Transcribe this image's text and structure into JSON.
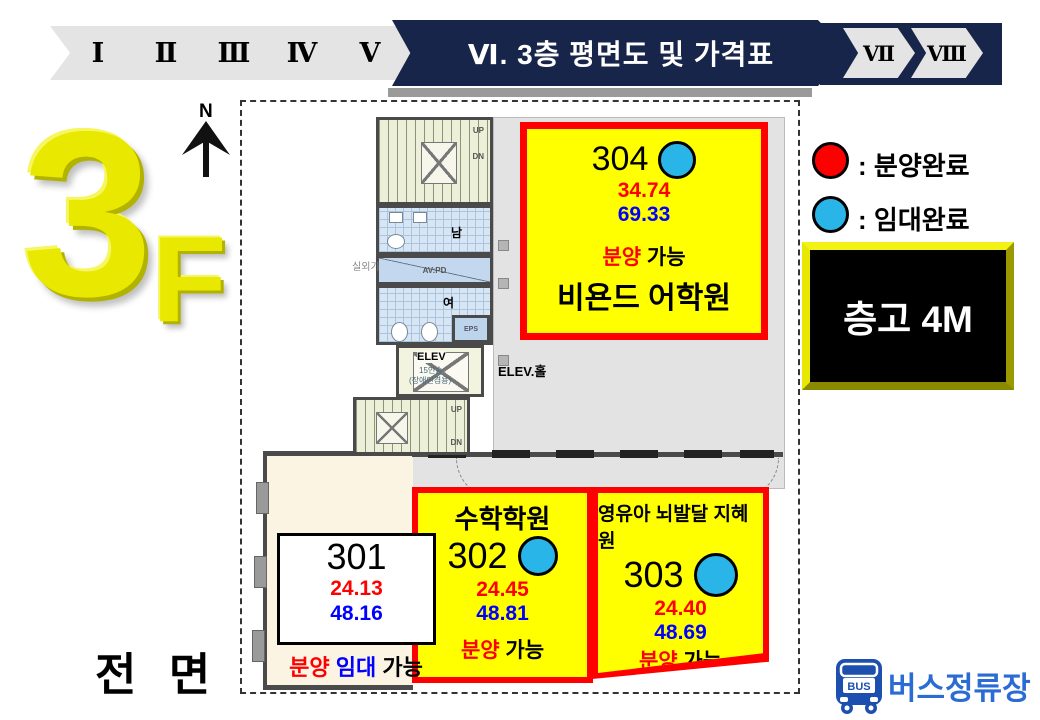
{
  "colors": {
    "navy": "#18254a",
    "highlight_yellow": "#ffff00",
    "sold_red": "#ff0000",
    "price_blue": "#0000ff",
    "leased_blue": "#29b5e8"
  },
  "header": {
    "steps": [
      "Ⅰ",
      "Ⅱ",
      "Ⅲ",
      "Ⅳ",
      "Ⅴ"
    ],
    "active_title": "Ⅵ. 3층 평면도 및 가격표",
    "steps_after": [
      "Ⅶ",
      "Ⅷ"
    ]
  },
  "floor_mark": {
    "big": "3",
    "small": "F"
  },
  "plan": {
    "north": "N",
    "outdoor_unit": "실외기",
    "up": "UP",
    "dn": "DN",
    "mens": "남",
    "womens": "여",
    "duct": "AV:PD",
    "eps": "EPS",
    "elev": "ELEV",
    "elev_capacity": "15인승",
    "elev_note": "(장애인겸용)",
    "elev_hall": "ELEV.홀",
    "front": "전 면"
  },
  "legend": {
    "items": [
      {
        "color": "#ff0000",
        "sep": ":",
        "label": "분양완료"
      },
      {
        "color": "#29b5e8",
        "sep": ":",
        "label": "임대완료"
      }
    ]
  },
  "ceiling_box": {
    "label": "층고 4M"
  },
  "rooms": {
    "r301": {
      "number": "301",
      "area1": "24.13",
      "area2": "48.16",
      "s1": "분양",
      "s2": "임대",
      "s3": "가능"
    },
    "r302": {
      "tenant": "수학학원",
      "number": "302",
      "area1": "24.45",
      "area2": "48.81",
      "s1": "분양",
      "s3": "가능"
    },
    "r303": {
      "tenant": "영유아 뇌발달 지혜원",
      "number": "303",
      "area1": "24.40",
      "area2": "48.69",
      "s1": "분양",
      "s3": "가능"
    },
    "r304": {
      "number": "304",
      "area1": "34.74",
      "area2": "69.33",
      "s1": "분양",
      "s3": "가능",
      "tenant": "비욘드 어학원"
    }
  },
  "bus_stop": {
    "badge": "BUS",
    "label": "버스정류장"
  }
}
